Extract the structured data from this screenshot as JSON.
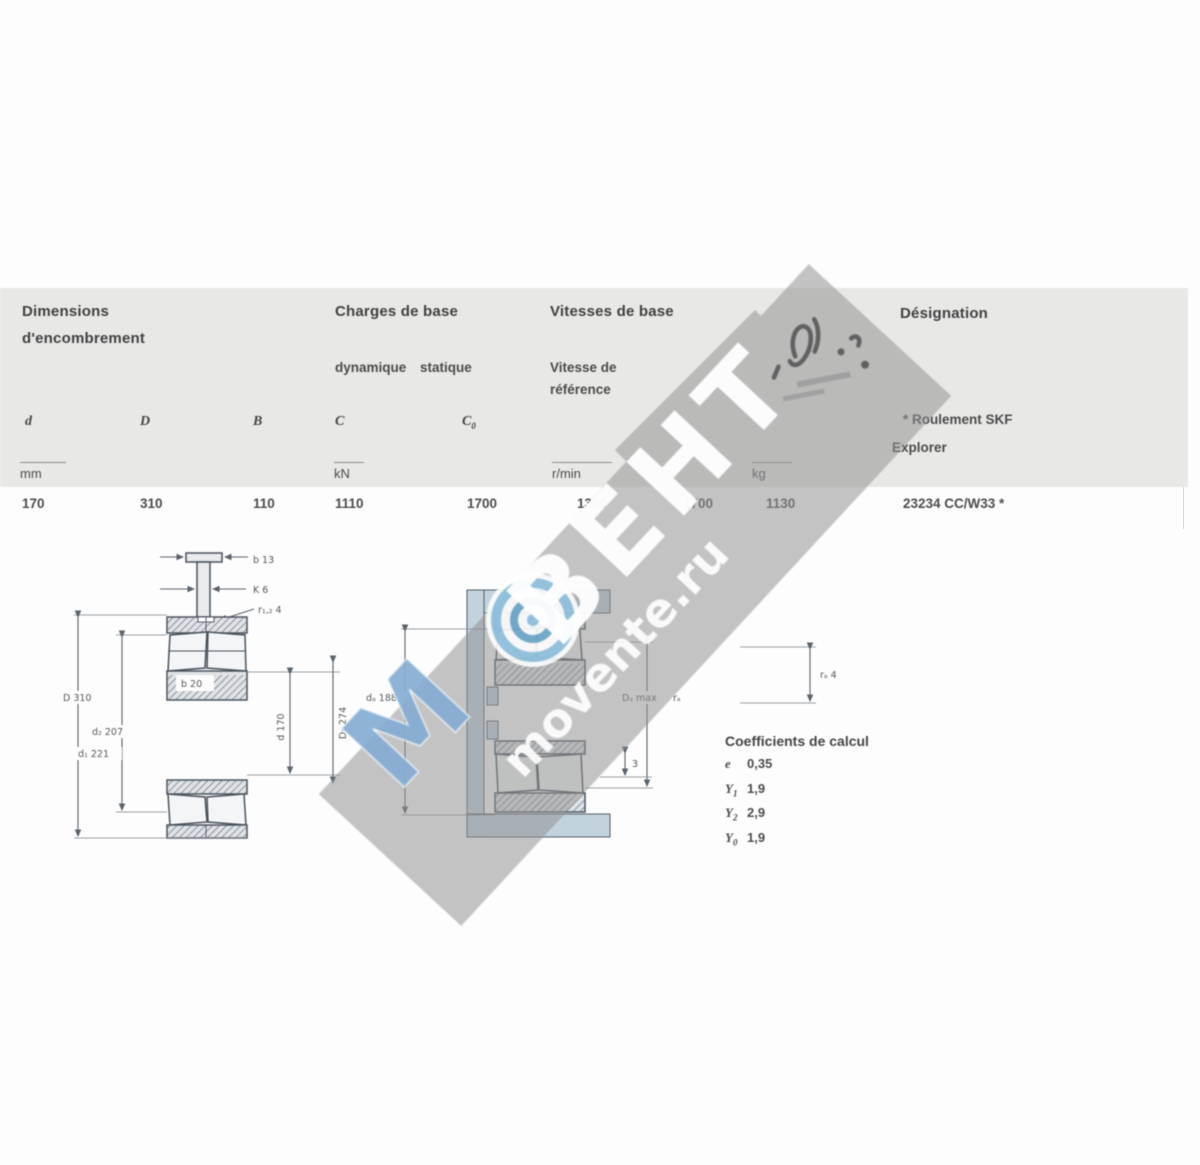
{
  "table": {
    "group_dimensions_line1": "Dimensions",
    "group_dimensions_line2": "d'encombrement",
    "group_charges": "Charges de base",
    "group_charges_sub1": "dynamique",
    "group_charges_sub2": "statique",
    "group_vitesses": "Vitesses de base",
    "group_vitesses_sub1": "Vitesse de",
    "group_vitesses_sub2": "référence",
    "group_designation": "Désignation",
    "note_line1": "* Roulement SKF",
    "note_line2": "Explorer",
    "sym_d": "d",
    "sym_D": "D",
    "sym_B": "B",
    "sym_C": "C",
    "sym_C0": "C",
    "sym_C0_sub": "0",
    "unit_mm": "mm",
    "unit_kN": "kN",
    "unit_rmin": "r/min",
    "unit_kg": "kg",
    "row": {
      "d": "170",
      "D": "310",
      "B": "110",
      "C": "1110",
      "C0": "1700",
      "speed_ref": "1300",
      "speed_lim": "1700",
      "mass": "1130",
      "designation": "23234 CC/W33 *"
    }
  },
  "coefficients": {
    "title": "Coefficients de calcul",
    "items": [
      {
        "sym": "e",
        "sub": "",
        "val": "0,35"
      },
      {
        "sym": "Y",
        "sub": "1",
        "val": "1,9"
      },
      {
        "sym": "Y",
        "sub": "2",
        "val": "2,9"
      },
      {
        "sym": "Y",
        "sub": "0",
        "val": "1,9"
      }
    ]
  },
  "drawings": {
    "left": {
      "b": "b 13",
      "K": "K 6",
      "r12": "r₁,₂ 4",
      "inner": "b 20",
      "D": "D 310",
      "d2": "d₂ 207",
      "d1": "d₁ 221",
      "d": "d 170",
      "D1": "D₁ 274"
    },
    "middle": {
      "da": "dₐ 188",
      "Da": "Dₐ max",
      "ra_small": "rₐ",
      "ra": "rₐ 4",
      "step": "3"
    }
  },
  "watermark": {
    "m": "М",
    "brand": "ВЕНТ",
    "site": "movente.ru"
  }
}
